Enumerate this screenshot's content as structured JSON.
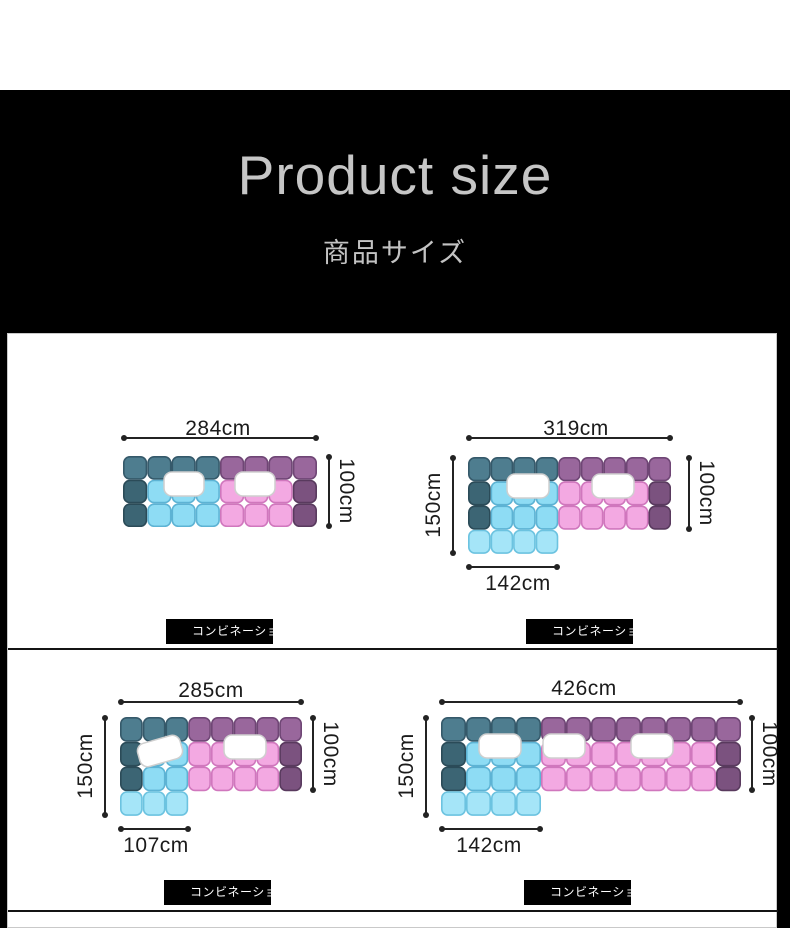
{
  "header": {
    "title": "Product size",
    "subtitle": "商品サイズ"
  },
  "colors": {
    "banner_bg": "#000000",
    "banner_text": "#c6c6c6",
    "dimension_text": "#1b1b1b",
    "tag_bg": "#000000",
    "tag_text": "#ffffff",
    "pillow_fill": "#ffffff",
    "pillow_stroke": "#cfcfcf",
    "palette": {
      "T": {
        "fill": "#4e7d8f",
        "stroke": "#35596a"
      },
      "t": {
        "fill": "#3c6574",
        "stroke": "#2b4b58"
      },
      "c": {
        "fill": "#8edcf4",
        "stroke": "#5db3d4"
      },
      "C": {
        "fill": "#a5e5f8",
        "stroke": "#6cc3e0"
      },
      "P": {
        "fill": "#99679c",
        "stroke": "#6f4675"
      },
      "d": {
        "fill": "#7b527f",
        "stroke": "#593a5e"
      },
      "p": {
        "fill": "#f3a9e2",
        "stroke": "#d077bd"
      }
    }
  },
  "diagrams": [
    {
      "name": "straight-sofa-284",
      "top_label": "284cm",
      "right_label": "100cm",
      "tag": "コンビネーショ",
      "sofa": {
        "cell_w": 24.25,
        "cell_h": 23.7,
        "rows": [
          "TTTTPPPP",
          "tcccpppd",
          "tcccpppd"
        ],
        "pillows": [
          {
            "x": 41,
            "y": 16,
            "w": 40,
            "h": 24,
            "rot": 0
          },
          {
            "x": 112,
            "y": 16,
            "w": 40,
            "h": 24,
            "rot": 0
          }
        ]
      }
    },
    {
      "name": "l-shape-sofa-319",
      "top_label": "319cm",
      "right_label": "100cm",
      "left_label": "150cm",
      "bottom_label": "142cm",
      "tag": "コンビネーショ",
      "sofa": {
        "cell_w": 22.56,
        "cell_h": 24.25,
        "rows": [
          "TTTTPPPPP",
          "tcccppppd",
          "tcccppppd",
          "CCCC....."
        ],
        "pillows": [
          {
            "x": 39,
            "y": 17,
            "w": 42,
            "h": 24,
            "rot": 0
          },
          {
            "x": 124,
            "y": 17,
            "w": 42,
            "h": 24,
            "rot": 0
          }
        ]
      }
    },
    {
      "name": "l-shape-sofa-285",
      "top_label": "285cm",
      "right_label": "100cm",
      "left_label": "150cm",
      "bottom_label": "107cm",
      "tag": "コンビネーショ",
      "sofa": {
        "cell_w": 22.75,
        "cell_h": 24.75,
        "rows": [
          "TTTPPPPP",
          "tccppppd",
          "tccppppd",
          "CCC....."
        ],
        "pillows": [
          {
            "x": 18,
            "y": 22,
            "w": 44,
            "h": 24,
            "rot": -16
          },
          {
            "x": 104,
            "y": 18,
            "w": 42,
            "h": 24,
            "rot": 0
          }
        ]
      }
    },
    {
      "name": "l-shape-sofa-426",
      "top_label": "426cm",
      "right_label": "100cm",
      "left_label": "150cm",
      "bottom_label": "142cm",
      "tag": "コンビネーショ",
      "sofa": {
        "cell_w": 25,
        "cell_h": 24.75,
        "rows": [
          "TTTTPPPPPPPP",
          "tcccpppppppd",
          "tcccpppppppd",
          "CCCC........"
        ],
        "pillows": [
          {
            "x": 38,
            "y": 17,
            "w": 42,
            "h": 24,
            "rot": 0
          },
          {
            "x": 102,
            "y": 17,
            "w": 42,
            "h": 24,
            "rot": 0
          },
          {
            "x": 190,
            "y": 17,
            "w": 42,
            "h": 24,
            "rot": 0
          }
        ]
      }
    }
  ]
}
